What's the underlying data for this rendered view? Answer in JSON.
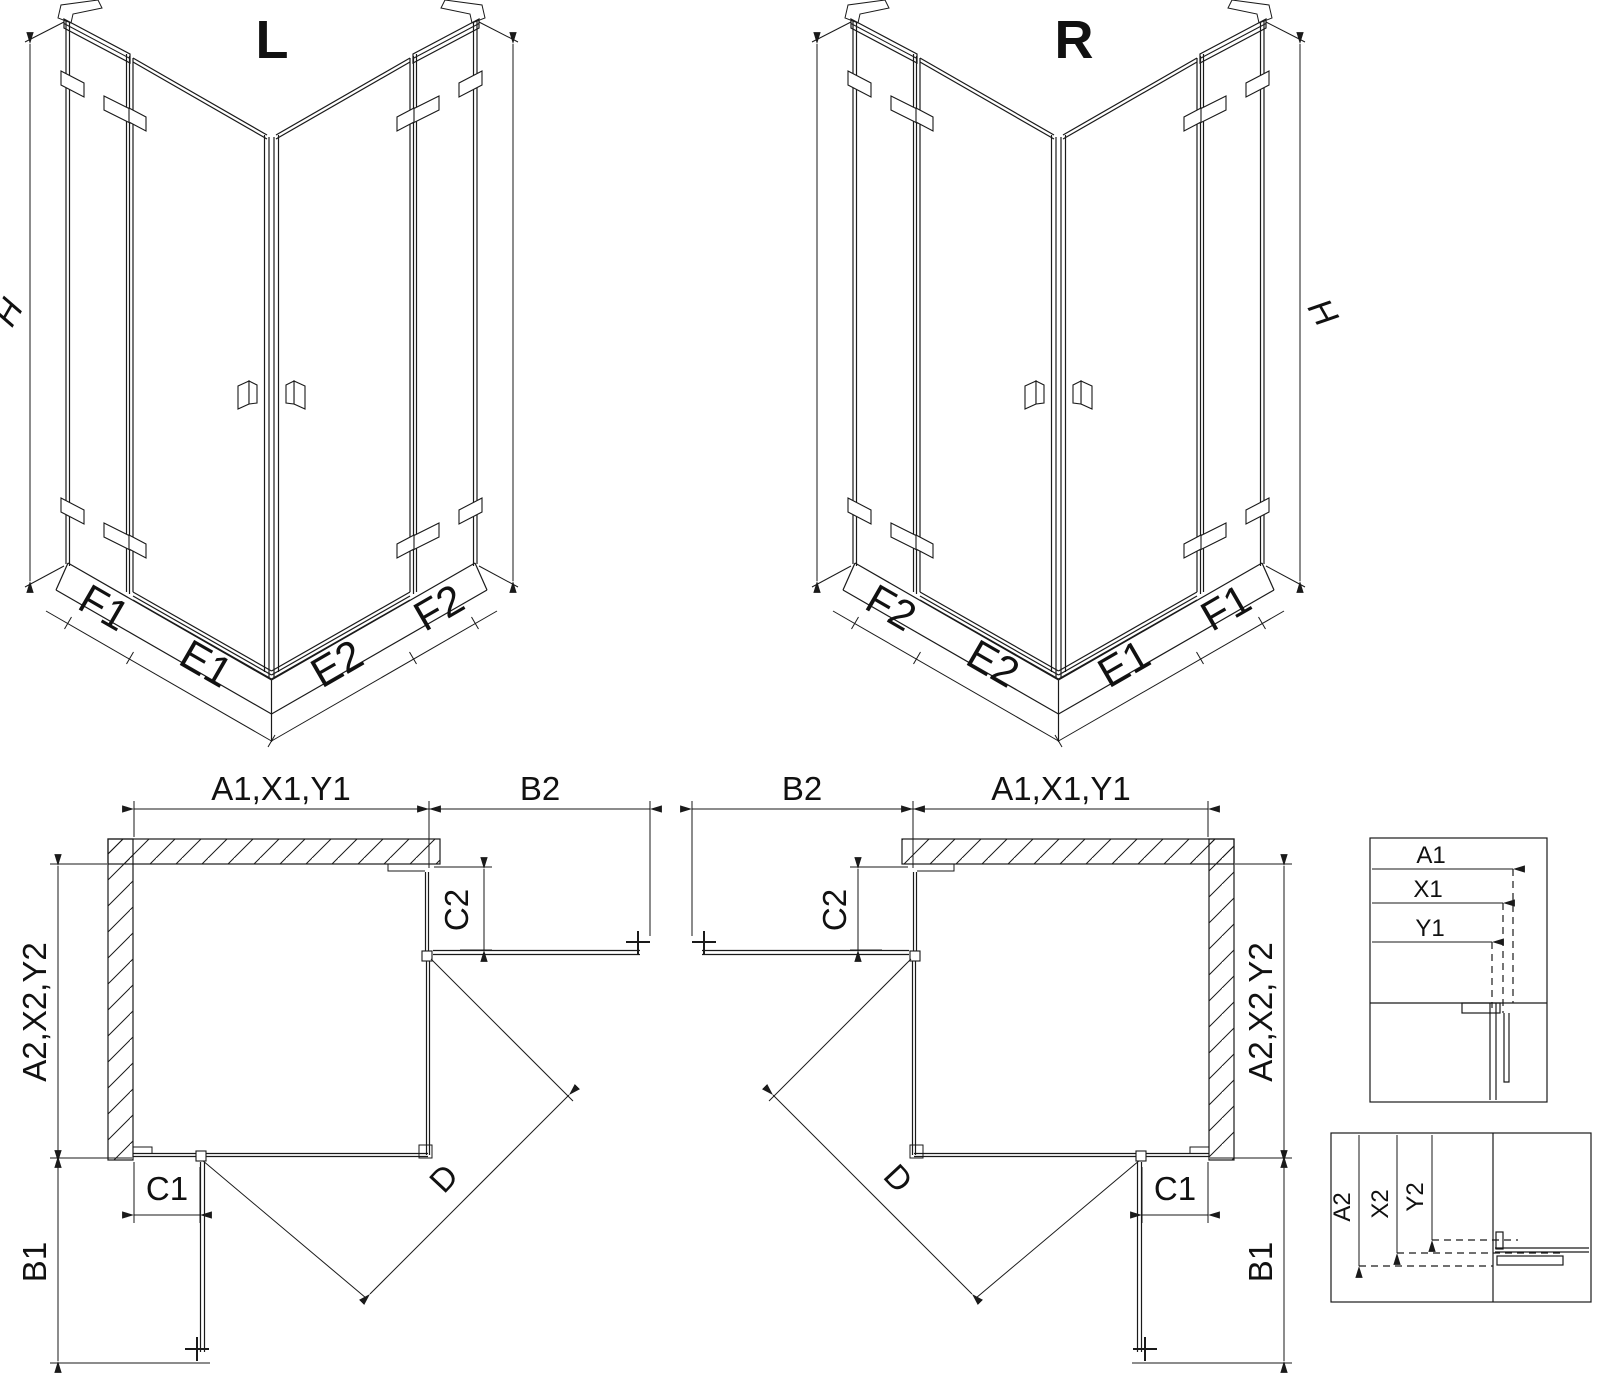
{
  "views": {
    "iso_left": {
      "title": "L",
      "height_label": "H",
      "segments": {
        "f1": "F1",
        "e1": "E1",
        "e2": "E2",
        "f2": "F2"
      }
    },
    "iso_right": {
      "title": "R",
      "height_label": "H",
      "segments": {
        "f2": "F2",
        "e2": "E2",
        "e1": "E1",
        "f1": "F1"
      }
    },
    "plan_left": {
      "width_top": "A1,X1,Y1",
      "return_top": "B2",
      "panel_top": "C2",
      "depth_side": "A2,X2,Y2",
      "panel_bottom": "C1",
      "return_bottom": "B1",
      "door_diagonal": "D"
    },
    "plan_right": {
      "width_top": "A1,X1,Y1",
      "return_top": "B2",
      "panel_top": "C2",
      "depth_side": "A2,X2,Y2",
      "panel_bottom": "C1",
      "return_bottom": "B1",
      "door_diagonal": "D"
    },
    "detail_widths": {
      "a1": "A1",
      "x1": "X1",
      "y1": "Y1"
    },
    "detail_depths": {
      "a2": "A2",
      "x2": "X2",
      "y2": "Y2"
    }
  },
  "colors": {
    "line": "#1a1a1a",
    "background": "#ffffff"
  }
}
